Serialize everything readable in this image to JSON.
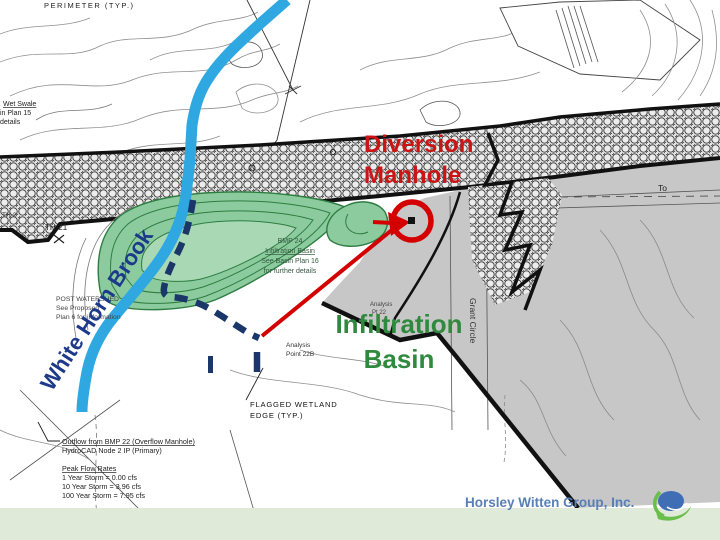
{
  "annotations": {
    "diversion": {
      "line1": "Diversion",
      "line2": "Manhole"
    },
    "infiltration": {
      "line1": "Infiltration",
      "line2": "Basin"
    },
    "brook_label": "White Horn Brook"
  },
  "footer": {
    "company": "Horsley Witten Group, Inc."
  },
  "map_labels": {
    "perimeter": "PERIMETER  (TYP.)",
    "wet_swale1": "Wet Swale",
    "wet_swale2": "in Plan 15",
    "wet_swale3": "details",
    "th2": "TH-2",
    "th21": "TH-21",
    "watershed1": "POST WATERSHED",
    "watershed2": "See Proposed",
    "watershed3": "Plan 6 for information",
    "basin1": "BMP 24",
    "basin2": "Infiltration Basin",
    "basin3": "See Basin Plan 16",
    "basin4": "for further details",
    "analysis_b1": "Analysis",
    "analysis_b2": "Point 22B",
    "analysis_a1": "Analysis",
    "analysis_a2": "Pt 22",
    "wetland1": "FLAGGED  WETLAND",
    "wetland2": "EDGE  (TYP.)",
    "grant_circle": "Grant Circle",
    "to": "To"
  },
  "stats": {
    "outflow_title": "Outflow from BMP 22 (Overflow Manhole)",
    "outflow_node": "HydroCAD Node 2 IP (Primary)",
    "peak_title": "Peak Flow Rates",
    "peak1": "1 Year Storm = 0.00 cfs",
    "peak10": "10 Year Storm = 3.96 cfs",
    "peak100": "100 Year Storm = 7.95 cfs"
  },
  "colors": {
    "annotation_red": "#cc1414",
    "annotation_green": "#2f8a3e",
    "annotation_navy": "#1d3a8a",
    "brook_blue": "#2fa8e2",
    "basin_fill": "#8ccb9e",
    "gray_area": "#c7c7c7",
    "footer_band": "#dfead8",
    "footer_text": "#5a7fb5"
  }
}
